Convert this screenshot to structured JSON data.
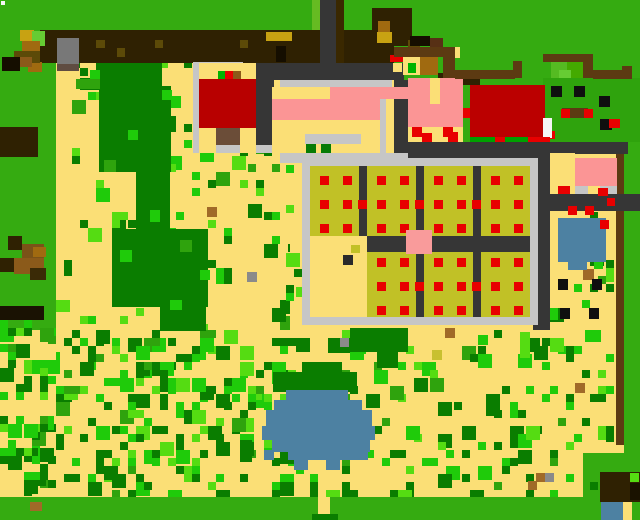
{
  "scene": {
    "width": 640,
    "height": 520,
    "kind": "pixel-farm-map"
  },
  "palette": {
    "tan": "#FBDF76",
    "grass": "#35AB11",
    "darkgreen": "#0A7D00",
    "bright": "#1FCB0A",
    "lime": "#55DC12",
    "midgreen": "#2FA30D",
    "fencebrown": "#2F2102",
    "saddle": "#5C3A12",
    "caramel": "#A06A10",
    "gold": "#C8A212",
    "olive": "#5C4A08",
    "blackish": "#150E00",
    "road": "#363636",
    "roadbrown": "#3A2800",
    "lightgray": "#C6C6C6",
    "bingray": "#787878",
    "binbase": "#5F4C41",
    "red": "#E80000",
    "coopred": "#B80000",
    "barnred": "#BB0000",
    "doorbrown": "#6B4D38",
    "pink": "#FB9595",
    "pinksq": "#F99B9B",
    "plotolive": "#C1C126",
    "blue": "#4D81A2",
    "white": "#F5F5F5",
    "dotblack": "#0F0F0F",
    "dotbrown": "#A06A28",
    "dotgray": "#8A8A8A",
    "bushl1": "#55BB22",
    "bushl2": "#44AA00",
    "bushl3": "#66CC33",
    "limecol": "#66BB22",
    "brown2": "#573015",
    "brown3": "#8B5A1A",
    "logbrown": "#7A5218",
    "logdark": "#3A2A06",
    "logblack": "#1A1203",
    "dkbrown2": "#1A1200",
    "grnpix": "#00B400",
    "grnstrip": "#00A000",
    "bushdark": "#067B06",
    "oliveyellow": "#C8C030",
    "emptydot": "#2A2A2A"
  },
  "base_rects": [
    [
      "tan",
      0,
      0,
      640,
      520
    ],
    [
      "grass",
      0,
      0,
      640,
      30
    ],
    [
      "grass",
      0,
      30,
      56,
      300
    ],
    [
      "grass",
      394,
      0,
      246,
      142
    ],
    [
      "grass",
      344,
      0,
      50,
      63
    ],
    [
      "grass",
      624,
      142,
      16,
      311
    ],
    [
      "grass",
      0,
      497,
      640,
      23
    ],
    [
      "grass",
      583,
      453,
      57,
      44
    ],
    [
      "grass",
      624,
      453,
      16,
      44
    ]
  ],
  "scatter_zones": [
    {
      "x": 0,
      "y": 320,
      "w": 60,
      "h": 177,
      "density": 0.5,
      "seed": 11
    },
    {
      "x": 56,
      "y": 330,
      "w": 254,
      "h": 167,
      "density": 0.4,
      "seed": 22
    },
    {
      "x": 56,
      "y": 140,
      "w": 234,
      "h": 190,
      "density": 0.12,
      "seed": 33
    },
    {
      "x": 72,
      "y": 60,
      "w": 120,
      "h": 84,
      "density": 0.15,
      "seed": 44
    },
    {
      "x": 310,
      "y": 330,
      "w": 304,
      "h": 167,
      "density": 0.2,
      "seed": 55
    },
    {
      "x": 550,
      "y": 212,
      "w": 64,
      "h": 118,
      "density": 0.13,
      "seed": 66
    },
    {
      "x": 286,
      "y": 165,
      "w": 22,
      "h": 165,
      "density": 0.18,
      "seed": 77
    },
    {
      "x": 420,
      "y": 165,
      "w": 108,
      "h": 165,
      "density": 0.04,
      "seed": 88
    }
  ],
  "scatter_colors": [
    {
      "key": "darkgreen",
      "w": 0.45
    },
    {
      "key": "bright",
      "w": 0.3
    },
    {
      "key": "lime",
      "w": 0.15
    },
    {
      "key": "midgreen",
      "w": 0.1
    }
  ],
  "field_rects": [
    [
      "darkgreen",
      96,
      63,
      66,
      27
    ],
    [
      "darkgreen",
      80,
      78,
      20,
      12
    ],
    [
      "darkgreen",
      99,
      86,
      72,
      86
    ],
    [
      "darkgreen",
      136,
      170,
      34,
      60
    ],
    [
      "darkgreen",
      112,
      229,
      96,
      78
    ],
    [
      "darkgreen",
      160,
      305,
      46,
      26
    ],
    [
      "bright",
      90,
      70,
      10,
      10
    ],
    [
      "bright",
      162,
      90,
      10,
      10
    ],
    [
      "bright",
      171,
      96,
      10,
      12
    ],
    [
      "bright",
      128,
      130,
      10,
      10
    ],
    [
      "bright",
      150,
      210,
      10,
      12
    ],
    [
      "bright",
      120,
      250,
      12,
      12
    ],
    [
      "bright",
      200,
      270,
      10,
      10
    ],
    [
      "bright",
      170,
      300,
      12,
      10
    ],
    [
      "midgreen",
      76,
      79,
      24,
      10
    ],
    [
      "midgreen",
      104,
      160,
      12,
      12
    ],
    [
      "midgreen",
      180,
      240,
      12,
      12
    ],
    [
      "darkgreen",
      350,
      328,
      58,
      24
    ],
    [
      "darkgreen",
      377,
      350,
      21,
      18
    ],
    [
      "darkgreen",
      328,
      338,
      22,
      15
    ],
    [
      "darkgreen",
      273,
      372,
      84,
      20
    ],
    [
      "darkgreen",
      302,
      362,
      40,
      12
    ],
    [
      "darkgreen",
      240,
      440,
      12,
      22
    ],
    [
      "lime",
      520,
      332,
      10,
      26
    ],
    [
      "lime",
      296,
      287,
      10,
      10
    ],
    [
      "lime",
      56,
      300,
      14,
      12
    ],
    [
      "bright",
      478,
      335,
      10,
      10
    ],
    [
      "bright",
      594,
      255,
      9,
      14
    ],
    [
      "bright",
      540,
      296,
      10,
      12
    ],
    [
      "bright",
      548,
      308,
      10,
      12
    ],
    [
      "bright",
      585,
      330,
      16,
      12
    ],
    [
      "dotbrown",
      207,
      207,
      10,
      10
    ],
    [
      "dotbrown",
      445,
      328,
      10,
      10
    ],
    [
      "dotbrown",
      575,
      383,
      10,
      10
    ],
    [
      "dotbrown",
      583,
      269,
      11,
      11
    ],
    [
      "dotbrown",
      528,
      481,
      9,
      9
    ],
    [
      "dotbrown",
      536,
      473,
      9,
      9
    ],
    [
      "dotbrown",
      30,
      502,
      12,
      9
    ],
    [
      "dotgray",
      247,
      272,
      10,
      10
    ],
    [
      "dotgray",
      340,
      338,
      9,
      9
    ],
    [
      "dotgray",
      545,
      473,
      9,
      9
    ],
    [
      "oliveyellow",
      432,
      350,
      10,
      10
    ],
    [
      "dotblack",
      558,
      279,
      10,
      11
    ],
    [
      "dotblack",
      592,
      279,
      10,
      11
    ],
    [
      "dotblack",
      560,
      308,
      10,
      11
    ],
    [
      "dotblack",
      589,
      308,
      10,
      11
    ]
  ],
  "structure_rects": [
    [
      "fencebrown",
      40,
      30,
      354,
      33
    ],
    [
      "fencebrown",
      372,
      8,
      40,
      38
    ],
    [
      "caramel",
      378,
      21,
      12,
      12
    ],
    [
      "gold",
      20,
      30,
      14,
      11
    ],
    [
      "gold",
      266,
      32,
      26,
      9
    ],
    [
      "gold",
      377,
      32,
      15,
      11
    ],
    [
      "bushl3",
      32,
      31,
      13,
      15
    ],
    [
      "caramel",
      22,
      41,
      18,
      12
    ],
    [
      "caramel",
      28,
      62,
      14,
      10
    ],
    [
      "olive",
      14,
      51,
      26,
      12
    ],
    [
      "olive",
      96,
      40,
      9,
      8
    ],
    [
      "olive",
      117,
      48,
      8,
      9
    ],
    [
      "olive",
      155,
      40,
      8,
      8
    ],
    [
      "olive",
      240,
      40,
      8,
      8
    ],
    [
      "olive",
      408,
      40,
      12,
      11
    ],
    [
      "blackish",
      2,
      57,
      18,
      14
    ],
    [
      "blackish",
      276,
      46,
      10,
      16
    ],
    [
      "blackish",
      410,
      36,
      20,
      10
    ],
    [
      "brown2",
      430,
      38,
      13,
      16
    ],
    [
      "tan",
      420,
      47,
      10,
      11
    ],
    [
      "tan",
      445,
      47,
      15,
      11
    ],
    [
      "brown3",
      20,
      57,
      12,
      10
    ],
    [
      "bingray",
      57,
      38,
      22,
      26
    ],
    [
      "binbase",
      57,
      64,
      22,
      7
    ],
    [
      "red",
      390,
      55,
      13,
      7
    ],
    [
      "fencebrown",
      0,
      127,
      38,
      30
    ],
    [
      "fencebrown",
      8,
      236,
      14,
      14
    ],
    [
      "logbrown",
      22,
      244,
      22,
      14
    ],
    [
      "fencebrown",
      0,
      258,
      14,
      14
    ],
    [
      "brown3",
      14,
      258,
      30,
      16
    ],
    [
      "logdark",
      30,
      268,
      16,
      12
    ],
    [
      "logblack",
      0,
      306,
      44,
      14
    ],
    [
      "caramel",
      33,
      247,
      13,
      10
    ],
    [
      "limecol",
      312,
      0,
      8,
      30
    ],
    [
      "road",
      320,
      0,
      16,
      63
    ],
    [
      "roadbrown",
      336,
      0,
      8,
      63
    ],
    [
      "road",
      256,
      63,
      148,
      17
    ],
    [
      "tan",
      393,
      63,
      9,
      9
    ],
    [
      "road",
      256,
      80,
      18,
      73
    ],
    [
      "road",
      394,
      80,
      14,
      85
    ],
    [
      "lightgray",
      193,
      62,
      6,
      91
    ],
    [
      "lightgray",
      193,
      62,
      50,
      6
    ],
    [
      "lightgray",
      193,
      145,
      86,
      8
    ],
    [
      "tan",
      199,
      63,
      57,
      16
    ],
    [
      "grnpix",
      218,
      71,
      7,
      8
    ],
    [
      "red",
      225,
      71,
      8,
      8
    ],
    [
      "brown3",
      233,
      71,
      8,
      8
    ],
    [
      "coopred",
      199,
      79,
      57,
      49
    ],
    [
      "doorbrown",
      216,
      128,
      24,
      17
    ],
    [
      "tan",
      199,
      128,
      17,
      25
    ],
    [
      "tan",
      240,
      128,
      16,
      25
    ],
    [
      "lightgray",
      280,
      80,
      112,
      7
    ],
    [
      "tan",
      272,
      87,
      58,
      12
    ],
    [
      "pink",
      330,
      87,
      94,
      12
    ],
    [
      "pink",
      272,
      99,
      108,
      21
    ],
    [
      "lightgray",
      380,
      99,
      6,
      56
    ],
    [
      "tan",
      386,
      99,
      8,
      64
    ],
    [
      "tan",
      272,
      120,
      108,
      34
    ],
    [
      "lightgray",
      305,
      134,
      56,
      10
    ],
    [
      "bushdark",
      306,
      144,
      10,
      10
    ],
    [
      "bushdark",
      321,
      144,
      10,
      10
    ],
    [
      "lightgray",
      280,
      153,
      140,
      10
    ],
    [
      "tan",
      403,
      55,
      17,
      20
    ],
    [
      "caramel",
      420,
      57,
      18,
      18
    ],
    [
      "fencebrown",
      438,
      73,
      42,
      12
    ],
    [
      "grnpix",
      408,
      63,
      8,
      10
    ],
    [
      "pink",
      408,
      78,
      55,
      49
    ],
    [
      "tan",
      430,
      78,
      10,
      26
    ],
    [
      "road",
      433,
      127,
      10,
      15
    ],
    [
      "tan",
      408,
      127,
      55,
      15
    ],
    [
      "red",
      412,
      127,
      10,
      10
    ],
    [
      "red",
      443,
      127,
      10,
      10
    ],
    [
      "red",
      422,
      133,
      10,
      10
    ],
    [
      "red",
      448,
      132,
      10,
      10
    ],
    [
      "grass",
      463,
      85,
      7,
      23
    ],
    [
      "red",
      463,
      108,
      8,
      10
    ],
    [
      "midgreen",
      543,
      78,
      97,
      64
    ],
    [
      "saddle",
      562,
      108,
      26,
      10
    ],
    [
      "dotblack",
      551,
      86,
      11,
      11
    ],
    [
      "dotblack",
      574,
      86,
      11,
      11
    ],
    [
      "dotblack",
      599,
      96,
      11,
      11
    ],
    [
      "dotblack",
      600,
      119,
      12,
      11
    ],
    [
      "red",
      561,
      109,
      9,
      9
    ],
    [
      "red",
      584,
      109,
      9,
      9
    ],
    [
      "red",
      609,
      119,
      11,
      9
    ],
    [
      "red",
      547,
      131,
      8,
      8
    ],
    [
      "barnred",
      470,
      85,
      75,
      52
    ],
    [
      "white",
      543,
      118,
      9,
      20
    ],
    [
      "grnstrip",
      470,
      137,
      80,
      6
    ],
    [
      "red",
      495,
      137,
      10,
      6
    ],
    [
      "red",
      528,
      137,
      22,
      6
    ],
    [
      "saddle",
      394,
      47,
      50,
      10
    ],
    [
      "saddle",
      443,
      47,
      12,
      31
    ],
    [
      "saddle",
      455,
      70,
      60,
      9
    ],
    [
      "saddle",
      513,
      61,
      9,
      17
    ],
    [
      "saddle",
      543,
      54,
      48,
      8
    ],
    [
      "saddle",
      583,
      54,
      10,
      24
    ],
    [
      "bushl1",
      551,
      62,
      16,
      16
    ],
    [
      "bushl2",
      567,
      62,
      16,
      16
    ],
    [
      "bushl3",
      559,
      70,
      12,
      8
    ],
    [
      "saddle",
      593,
      70,
      31,
      9
    ],
    [
      "saddle",
      622,
      66,
      10,
      13
    ],
    [
      "saddle",
      616,
      142,
      8,
      52
    ],
    [
      "saddle",
      616,
      211,
      8,
      234
    ],
    [
      "road",
      408,
      142,
      220,
      12
    ],
    [
      "road",
      408,
      154,
      142,
      9
    ],
    [
      "road",
      533,
      163,
      17,
      167
    ],
    [
      "road",
      540,
      194,
      100,
      17
    ],
    [
      "tan",
      550,
      153,
      25,
      35
    ],
    [
      "pink",
      575,
      158,
      42,
      28
    ],
    [
      "lightgray",
      575,
      186,
      42,
      8
    ],
    [
      "red",
      558,
      186,
      12,
      8
    ],
    [
      "tan",
      588,
      186,
      12,
      8
    ],
    [
      "red",
      598,
      188,
      10,
      8
    ],
    [
      "red",
      607,
      198,
      8,
      8
    ],
    [
      "red",
      568,
      206,
      9,
      9
    ],
    [
      "red",
      585,
      206,
      9,
      9
    ],
    [
      "blue",
      558,
      218,
      48,
      44
    ],
    [
      "blue",
      568,
      262,
      19,
      8
    ],
    [
      "red",
      600,
      220,
      9,
      9
    ],
    [
      "blue",
      286,
      390,
      62,
      10
    ],
    [
      "blue",
      274,
      400,
      88,
      10
    ],
    [
      "blue",
      266,
      410,
      106,
      16
    ],
    [
      "blue",
      262,
      426,
      113,
      14
    ],
    [
      "blue",
      272,
      440,
      98,
      12
    ],
    [
      "blue",
      288,
      452,
      80,
      8
    ],
    [
      "blue",
      294,
      460,
      14,
      10
    ],
    [
      "blue",
      326,
      460,
      14,
      10
    ],
    [
      "blue",
      264,
      450,
      10,
      10
    ],
    [
      "fencebrown",
      600,
      472,
      40,
      30
    ],
    [
      "dkbrown2",
      630,
      483,
      10,
      17
    ],
    [
      "blue",
      601,
      502,
      22,
      18
    ],
    [
      "tan",
      623,
      502,
      9,
      18
    ],
    [
      "lime",
      630,
      473,
      9,
      9
    ],
    [
      "tan",
      318,
      497,
      12,
      23
    ],
    [
      "darkgreen",
      312,
      514,
      26,
      6
    ],
    [
      "lightgray",
      302,
      158,
      236,
      167
    ],
    [
      "road",
      310,
      166,
      220,
      151
    ],
    [
      "white",
      1,
      1,
      4,
      4
    ]
  ],
  "plots": {
    "col_x": [
      310,
      367,
      424,
      481
    ],
    "col_w": 49,
    "top_y": 166,
    "top_h": 70,
    "bottom_y": 252,
    "bottom_h": 65,
    "dot": 9,
    "dot_dx": [
      10,
      33
    ],
    "top_rows": [
      176,
      200,
      224
    ],
    "bottom_rows": [
      258,
      282,
      306
    ],
    "gap_dot_x": [
      358,
      415,
      472
    ],
    "mid_rows": [
      200,
      282
    ],
    "empty": [
      310,
      236,
      57,
      81
    ],
    "empty_dot": [
      343,
      255,
      10,
      10
    ],
    "empty_olive": [
      351,
      245,
      9,
      8
    ],
    "pink_square": [
      406,
      230,
      26,
      24
    ]
  },
  "structures": [
    {
      "name": "farmhouse",
      "x": 272,
      "y": 80,
      "w": 152,
      "h": 83
    },
    {
      "name": "coop-building",
      "x": 193,
      "y": 62,
      "w": 86,
      "h": 91
    },
    {
      "name": "barn-building",
      "x": 470,
      "y": 85,
      "w": 80,
      "h": 58
    },
    {
      "name": "yard-cabin",
      "x": 408,
      "y": 55,
      "w": 55,
      "h": 87
    },
    {
      "name": "greenhouse-small",
      "x": 550,
      "y": 153,
      "w": 67,
      "h": 41
    },
    {
      "name": "crop-field",
      "x": 302,
      "y": 158,
      "w": 236,
      "h": 167
    },
    {
      "name": "field-center-marker",
      "x": 406,
      "y": 230,
      "w": 26,
      "h": 24
    },
    {
      "name": "pond-large",
      "x": 262,
      "y": 390,
      "w": 114,
      "h": 80
    },
    {
      "name": "pond-small",
      "x": 558,
      "y": 218,
      "w": 48,
      "h": 52
    },
    {
      "name": "shipping-bin",
      "x": 57,
      "y": 38,
      "w": 22,
      "h": 33
    },
    {
      "name": "north-road",
      "x": 320,
      "y": 0,
      "w": 24,
      "h": 63
    },
    {
      "name": "east-road",
      "x": 540,
      "y": 194,
      "w": 100,
      "h": 17
    },
    {
      "name": "fruit-trees",
      "x": 543,
      "y": 78,
      "w": 97,
      "h": 64
    },
    {
      "name": "hedge-bush",
      "x": 543,
      "y": 54,
      "w": 50,
      "h": 24
    },
    {
      "name": "corner-hut",
      "x": 600,
      "y": 472,
      "w": 40,
      "h": 48
    },
    {
      "name": "south-path-gap",
      "x": 318,
      "y": 497,
      "w": 12,
      "h": 23
    }
  ]
}
